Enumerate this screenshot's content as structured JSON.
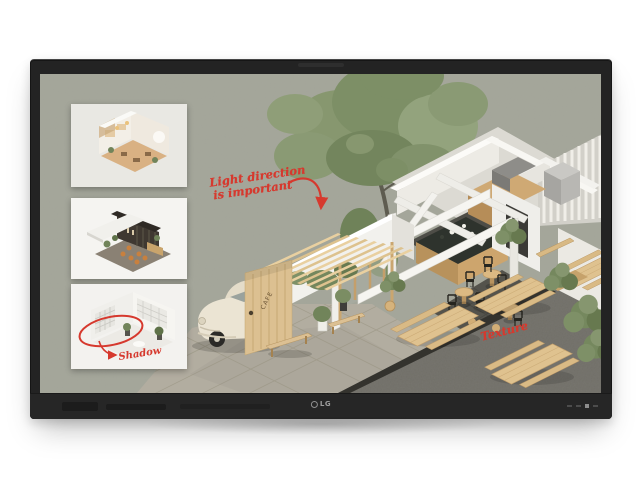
{
  "device": {
    "brand_label": "LG",
    "type": "interactive touch display",
    "bezel_color": "#232323"
  },
  "whiteboard": {
    "background_color": "#a5a79b",
    "ink_color": "#d6392e",
    "annotations": {
      "light_direction_line1": "Light direction",
      "light_direction_line2": "is important",
      "shadow": "Shadow",
      "texture": "Texture"
    },
    "scene": {
      "cafe_sign": "CAFE",
      "description": "isometric cutaway model of a cafe with tree, vintage car, wood pergola and picnic tables"
    },
    "thumbnails": [
      {
        "label": "warm-lit interior room model"
      },
      {
        "label": "dark wood cafe interior model"
      },
      {
        "label": "bright white room model"
      }
    ]
  }
}
